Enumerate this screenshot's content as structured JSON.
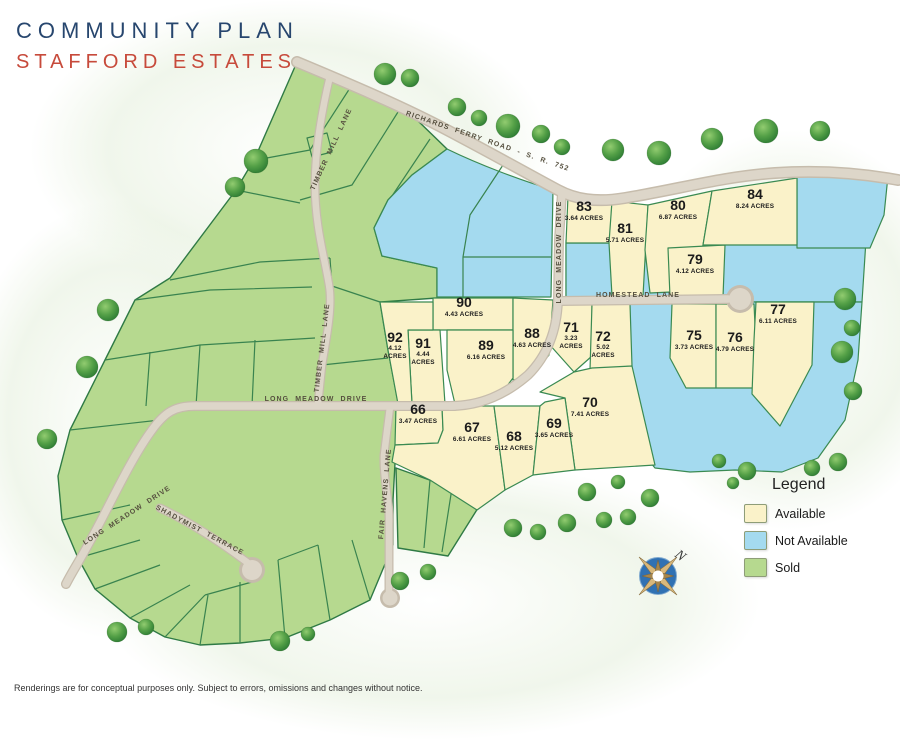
{
  "title": {
    "line1": "COMMUNITY PLAN",
    "line2": "STAFFORD ESTATES"
  },
  "legend": {
    "title": "Legend",
    "items": [
      {
        "label": "Available",
        "color": "#FAF2C9",
        "status": "available"
      },
      {
        "label": "Not Available",
        "color": "#A4DAEF",
        "status": "not-available"
      },
      {
        "label": "Sold",
        "color": "#B6D98F",
        "status": "sold"
      }
    ]
  },
  "disclaimer": {
    "text": "Renderings are for conceptual purposes only. Subject to errors, omissions and changes without notice."
  },
  "compass": {
    "label": "N",
    "icon": "compass-rose-icon"
  },
  "colors": {
    "title_blue": "#27466e",
    "title_red": "#c74a3b",
    "available": "#FAF2C9",
    "not_available": "#A4DAEF",
    "sold": "#B6D98F",
    "parcel_line": "#3a8a52",
    "road": "#DDD6C9"
  },
  "map": {
    "lots": [
      {
        "number": "66",
        "acres": "3.47 ACRES",
        "x": 418,
        "y": 414
      },
      {
        "number": "67",
        "acres": "6.61 ACRES",
        "x": 472,
        "y": 432
      },
      {
        "number": "68",
        "acres": "5.12 ACRES",
        "x": 514,
        "y": 441
      },
      {
        "number": "69",
        "acres": "3.65 ACRES",
        "x": 554,
        "y": 428
      },
      {
        "number": "70",
        "acres": "7.41 ACRES",
        "x": 590,
        "y": 407
      },
      {
        "number": "71",
        "acres": "3.23 ACRES",
        "x": 571,
        "y": 332,
        "stack": true
      },
      {
        "number": "72",
        "acres": "5.02 ACRES",
        "x": 603,
        "y": 341,
        "stack": true
      },
      {
        "number": "75",
        "acres": "3.73 ACRES",
        "x": 694,
        "y": 340
      },
      {
        "number": "76",
        "acres": "4.79 ACRES",
        "x": 735,
        "y": 342
      },
      {
        "number": "77",
        "acres": "6.11 ACRES",
        "x": 778,
        "y": 314
      },
      {
        "number": "79",
        "acres": "4.12 ACRES",
        "x": 695,
        "y": 264
      },
      {
        "number": "80",
        "acres": "6.87 ACRES",
        "x": 678,
        "y": 210
      },
      {
        "number": "81",
        "acres": "5.71 ACRES",
        "x": 625,
        "y": 233
      },
      {
        "number": "83",
        "acres": "3.64 ACRES",
        "x": 584,
        "y": 211
      },
      {
        "number": "84",
        "acres": "8.24 ACRES",
        "x": 755,
        "y": 199
      },
      {
        "number": "88",
        "acres": "4.63 ACRES",
        "x": 532,
        "y": 338
      },
      {
        "number": "89",
        "acres": "6.16 ACRES",
        "x": 486,
        "y": 350
      },
      {
        "number": "90",
        "acres": "4.43 ACRES",
        "x": 464,
        "y": 307
      },
      {
        "number": "91",
        "acres": "4.44 ACRES",
        "x": 423,
        "y": 348,
        "stack": true
      },
      {
        "number": "92",
        "acres": "4.12 ACRES",
        "x": 395,
        "y": 342,
        "stack": true
      }
    ],
    "road_labels": [
      {
        "name": "RICHARDS FERRY ROAD - S. R. 752",
        "x": 487,
        "y": 143,
        "rotate": 19
      },
      {
        "name": "LONG MEADOW DRIVE",
        "x": 561,
        "y": 252,
        "rotate": -90
      },
      {
        "name": "HOMESTEAD LANE",
        "x": 638,
        "y": 297,
        "rotate": 0
      },
      {
        "name": "LONG MEADOW DRIVE",
        "x": 316,
        "y": 401,
        "rotate": 0
      },
      {
        "name": "TIMBER MILL LANE",
        "x": 333,
        "y": 150,
        "rotate": -65
      },
      {
        "name": "TIMBER MILL LANE",
        "x": 324,
        "y": 348,
        "rotate": -83
      },
      {
        "name": "FAIR HAVENS LANE",
        "x": 387,
        "y": 494,
        "rotate": -85
      },
      {
        "name": "LONG MEADOW DRIVE",
        "x": 128,
        "y": 517,
        "rotate": -33
      },
      {
        "name": "SHADYMIST TERRACE",
        "x": 199,
        "y": 532,
        "rotate": 28
      }
    ]
  }
}
